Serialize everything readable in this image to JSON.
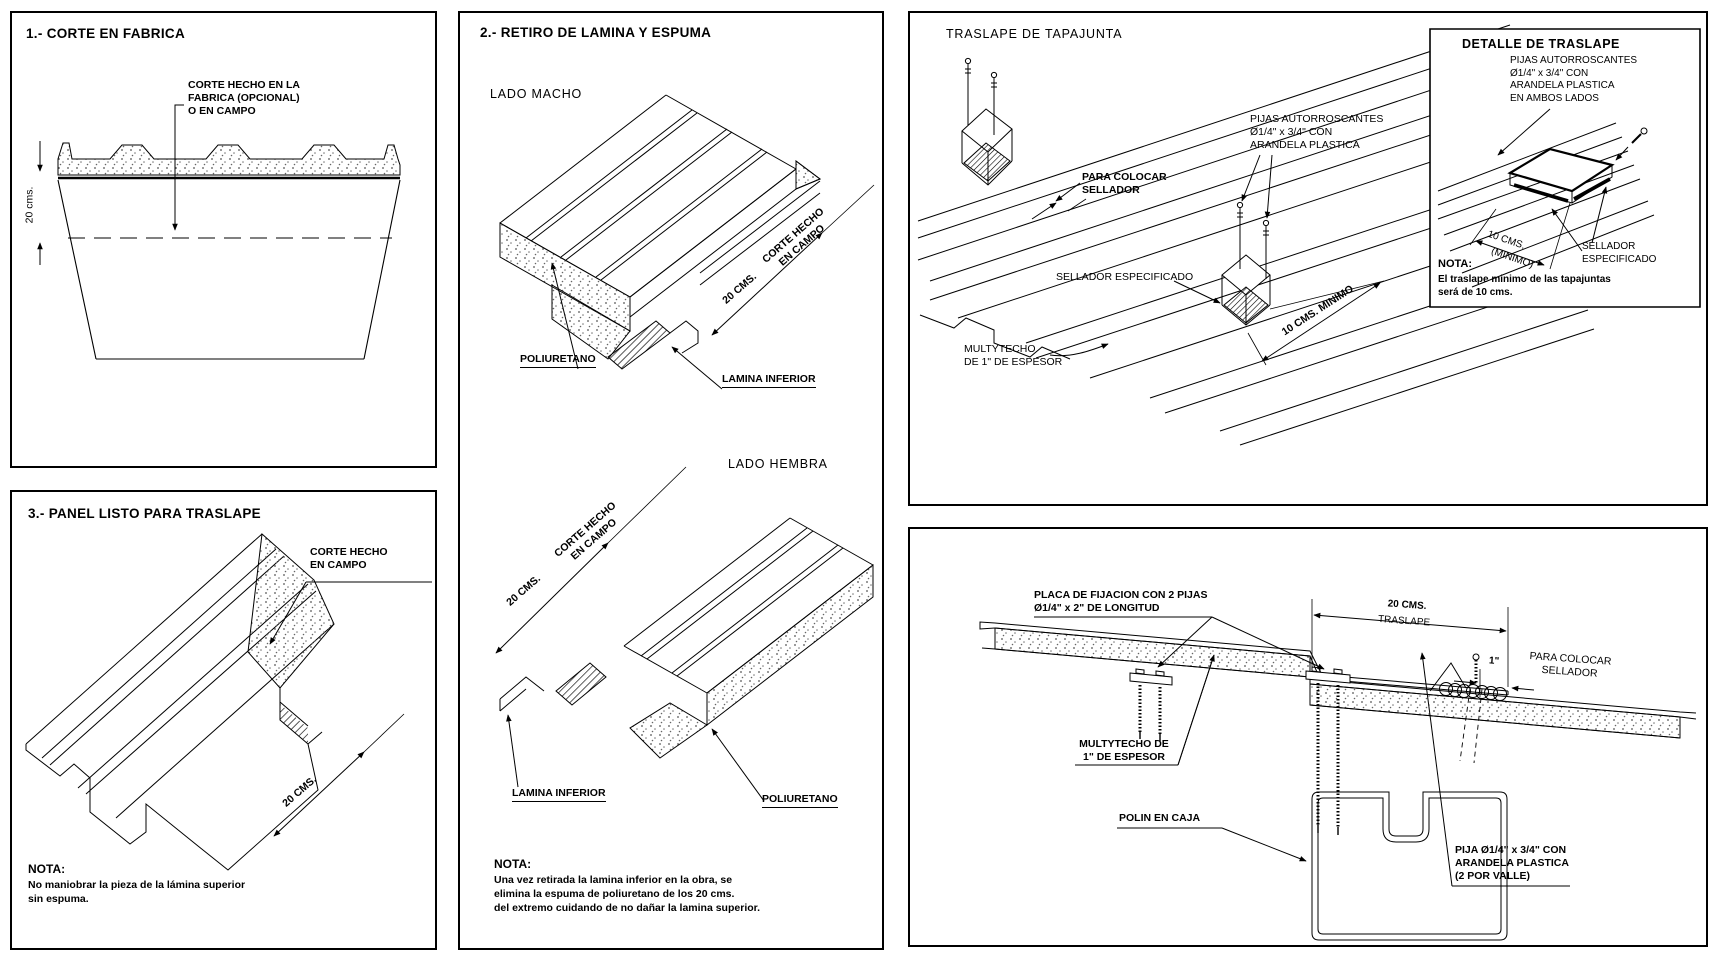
{
  "p1": {
    "title": "1.- CORTE EN FABRICA",
    "callout": "CORTE HECHO EN LA\nFABRICA (OPCIONAL)\nO EN CAMPO",
    "dim": "20 cms."
  },
  "p2": {
    "title": "3.- PANEL LISTO PARA TRASLAPE",
    "callout": "CORTE HECHO\nEN CAMPO",
    "dim": "20 CMS.",
    "note_title": "NOTA:",
    "note_body": "No maniobrar la pieza de la lámina superior\nsin espuma."
  },
  "p3": {
    "title": "2.- RETIRO DE LAMINA Y ESPUMA",
    "lado_macho": "LADO MACHO",
    "lado_hembra": "LADO HEMBRA",
    "poliuretano": "POLIURETANO",
    "lamina_inferior": "LAMINA INFERIOR",
    "corte": "CORTE HECHO\nEN CAMPO",
    "dim": "20 CMS.",
    "note_title": "NOTA:",
    "note_body": "Una vez retirada la lamina inferior en la obra, se\nelimina la espuma de poliuretano de los 20 cms.\ndel extremo cuidando de no dañar la lamina superior."
  },
  "p4": {
    "title": "TRASLAPE DE TAPAJUNTA",
    "pijas": "PIJAS AUTORROSCANTES\nØ1/4\" x 3/4\" CON\nARANDELA PLASTICA",
    "para_colocar": "PARA COLOCAR\nSELLADOR",
    "sellador": "SELLADOR ESPECIFICADO",
    "dim": "10 CMS. MINIMO",
    "multytecho": "MULTYTECHO\nDE 1\" DE ESPESOR",
    "detalle": {
      "title": "DETALLE DE TRASLAPE",
      "pijas": "PIJAS AUTORROSCANTES\nØ1/4\" x 3/4\" CON\nARANDELA PLASTICA\nEN AMBOS LADOS",
      "dim_cms": "10 CMS.",
      "dim_min": "(MINIMO)",
      "sellador": "SELLADOR\nESPECIFICADO",
      "note_title": "NOTA:",
      "note_body": "El traslape minimo de las tapajuntas\nserá de 10 cms."
    }
  },
  "p5": {
    "placa": "PLACA DE FIJACION CON 2 PIJAS\nØ1/4\" x 2\" DE LONGITUD",
    "dim_20": "20 CMS.",
    "traslape": "TRASLAPE",
    "dim_1": "1\"",
    "para_colocar": "PARA COLOCAR\nSELLADOR",
    "multytecho": "MULTYTECHO DE\n1\" DE ESPESOR",
    "polin": "POLIN EN CAJA",
    "pija": "PIJA Ø1/4\" x 3/4\" CON\nARANDELA PLASTICA\n(2 POR VALLE)"
  }
}
